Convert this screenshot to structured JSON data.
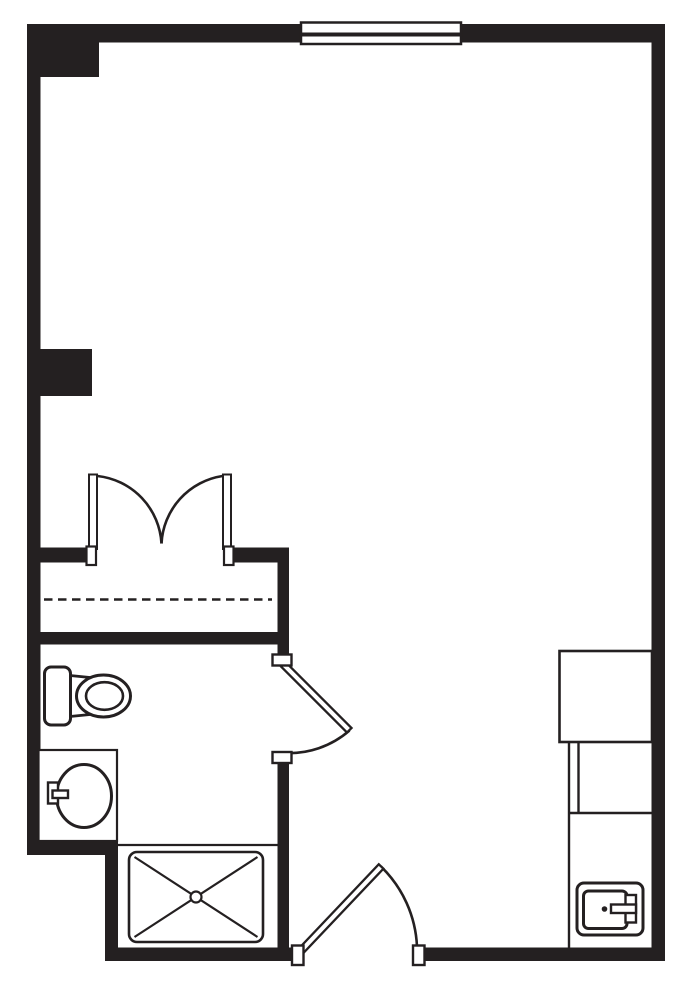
{
  "document": {
    "type": "floor-plan",
    "description": "Single-unit studio floor plan, black line drawing on white",
    "canvas": {
      "width": 686,
      "height": 981
    }
  },
  "colors": {
    "ink": "#242021",
    "paper": "#ffffff"
  },
  "plan": {
    "rooms": [
      {
        "id": "main-room",
        "position": "large open area, top and right"
      },
      {
        "id": "closet",
        "position": "middle left, with shelf dashed line"
      },
      {
        "id": "bathroom",
        "position": "lower left"
      },
      {
        "id": "kitchenette",
        "position": "lower right nook along right wall"
      }
    ],
    "openings": [
      {
        "id": "window-top",
        "type": "window",
        "wall": "top"
      },
      {
        "id": "closet-double-door",
        "type": "double-swing-door",
        "into": "closet"
      },
      {
        "id": "bathroom-door",
        "type": "swing-door",
        "into": "bathroom"
      },
      {
        "id": "entry-door",
        "type": "swing-door",
        "wall": "bottom"
      }
    ],
    "fixtures": [
      {
        "id": "toilet",
        "room": "bathroom"
      },
      {
        "id": "vanity-sink",
        "room": "bathroom"
      },
      {
        "id": "shower",
        "room": "bathroom",
        "symbol": "crossed rectangle with drain"
      },
      {
        "id": "closet-shelf",
        "room": "closet",
        "symbol": "dashed line"
      },
      {
        "id": "refrigerator",
        "room": "kitchenette"
      },
      {
        "id": "counter-cabinets",
        "room": "kitchenette"
      },
      {
        "id": "kitchenette-sink",
        "room": "kitchenette"
      }
    ]
  }
}
